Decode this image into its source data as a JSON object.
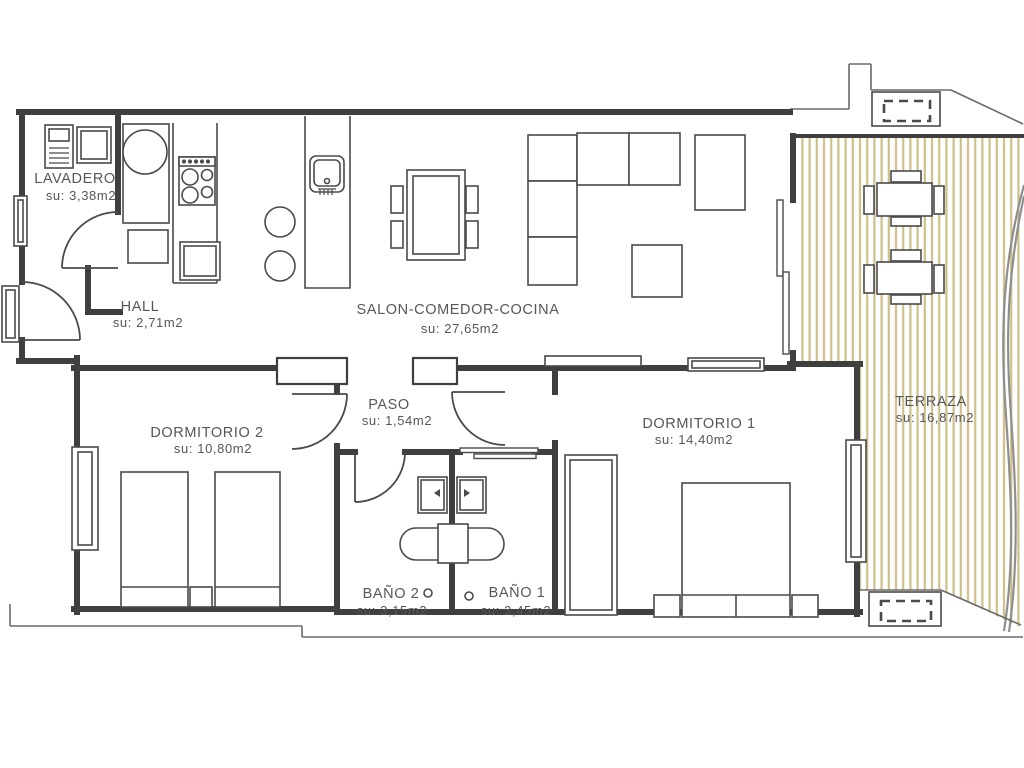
{
  "plan": {
    "rooms": [
      {
        "id": "lavadero",
        "name": "LAVADERO",
        "area": "su: 3,38m2"
      },
      {
        "id": "hall",
        "name": "HALL",
        "area": "su: 2,71m2"
      },
      {
        "id": "salon-comedor-cocina",
        "name": "SALON-COMEDOR-COCINA",
        "area": "su: 27,65m2"
      },
      {
        "id": "paso",
        "name": "PASO",
        "area": "su: 1,54m2"
      },
      {
        "id": "dormitorio-2",
        "name": "DORMITORIO 2",
        "area": "su: 10,80m2"
      },
      {
        "id": "dormitorio-1",
        "name": "DORMITORIO 1",
        "area": "su: 14,40m2"
      },
      {
        "id": "bano-2",
        "name": "BAÑO 2",
        "area": "su: 3,15m2"
      },
      {
        "id": "bano-1",
        "name": "BAÑO 1",
        "area": "su: 3,45m2"
      },
      {
        "id": "terraza",
        "name": "TERRAZA",
        "area": "su: 16,87m2"
      }
    ],
    "colors": {
      "wall": "#3f3f3f",
      "furniture_line": "#4a4a4a",
      "deck_stripe": "#cfc08a",
      "facade_curve": "#8f8f8f",
      "label_text": "#575757",
      "background": "#ffffff"
    }
  }
}
